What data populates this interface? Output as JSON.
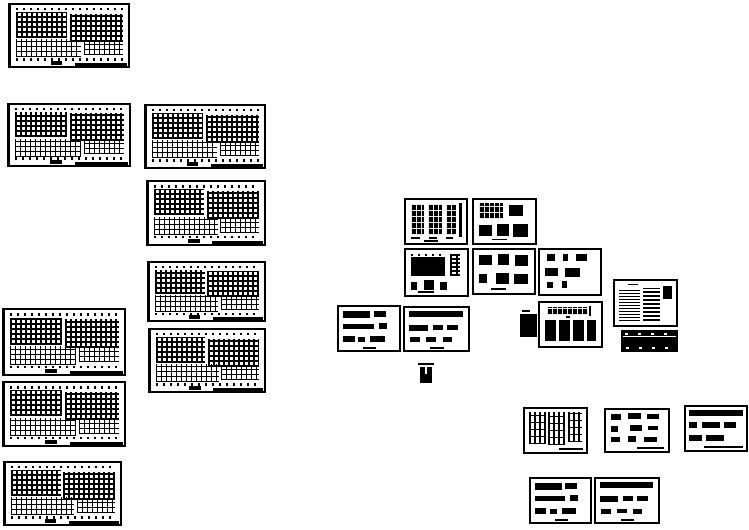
{
  "canvas": {
    "width": 749,
    "height": 530,
    "background_color": "#ffffff",
    "ink_color": "#000000",
    "description": "CAD drawing set preview, monochrome linework thumbnails"
  },
  "sheets": [
    {
      "name": "floor-plan-1",
      "kind": "floor-plan",
      "x": 8,
      "y": 3,
      "w": 122,
      "h": 65
    },
    {
      "name": "floor-plan-2",
      "kind": "floor-plan",
      "x": 7,
      "y": 103,
      "w": 124,
      "h": 64
    },
    {
      "name": "floor-plan-3",
      "kind": "floor-plan",
      "x": 144,
      "y": 104,
      "w": 122,
      "h": 65
    },
    {
      "name": "floor-plan-4",
      "kind": "floor-plan",
      "x": 146,
      "y": 180,
      "w": 120,
      "h": 66
    },
    {
      "name": "floor-plan-5",
      "kind": "floor-plan",
      "x": 147,
      "y": 261,
      "w": 119,
      "h": 61
    },
    {
      "name": "floor-plan-6",
      "kind": "floor-plan",
      "x": 148,
      "y": 328,
      "w": 118,
      "h": 65
    },
    {
      "name": "floor-plan-7",
      "kind": "floor-plan",
      "x": 2,
      "y": 308,
      "w": 124,
      "h": 68
    },
    {
      "name": "floor-plan-8",
      "kind": "floor-plan",
      "x": 2,
      "y": 381,
      "w": 124,
      "h": 66
    },
    {
      "name": "floor-plan-9",
      "kind": "floor-plan",
      "x": 3,
      "y": 461,
      "w": 119,
      "h": 65
    },
    {
      "name": "column-elevation-sheet",
      "kind": "column-elevations",
      "x": 404,
      "y": 198,
      "w": 64,
      "h": 47
    },
    {
      "name": "detail-sheet-a",
      "kind": "details-a",
      "x": 472,
      "y": 198,
      "w": 65,
      "h": 47
    },
    {
      "name": "beam-elevation-sheet",
      "kind": "beam-elevation",
      "x": 404,
      "y": 248,
      "w": 65,
      "h": 49
    },
    {
      "name": "detail-sheet-b",
      "kind": "details-b",
      "x": 472,
      "y": 248,
      "w": 64,
      "h": 47
    },
    {
      "name": "detail-sheet-c",
      "kind": "details-c",
      "x": 538,
      "y": 248,
      "w": 64,
      "h": 48
    },
    {
      "name": "general-notes-sheet",
      "kind": "general-notes",
      "x": 613,
      "y": 279,
      "w": 65,
      "h": 48
    },
    {
      "name": "schedule-table",
      "kind": "schedule-table",
      "x": 621,
      "y": 330,
      "w": 57,
      "h": 22
    },
    {
      "name": "bar-detail-sheet-1",
      "kind": "bar-details",
      "x": 337,
      "y": 305,
      "w": 64,
      "h": 47
    },
    {
      "name": "bar-detail-sheet-2",
      "kind": "bar-details-b",
      "x": 403,
      "y": 306,
      "w": 67,
      "h": 46
    },
    {
      "name": "solid-detail-chip",
      "kind": "black-chip",
      "x": 520,
      "y": 314,
      "w": 17,
      "h": 23
    },
    {
      "name": "beam-and-columns-sheet",
      "kind": "beam-columns",
      "x": 538,
      "y": 301,
      "w": 65,
      "h": 47
    },
    {
      "name": "small-section-mark",
      "kind": "small-section",
      "x": 420,
      "y": 367,
      "w": 12,
      "h": 16
    },
    {
      "name": "wall-section-sheet",
      "kind": "wall-sections",
      "x": 523,
      "y": 407,
      "w": 65,
      "h": 47
    },
    {
      "name": "detail-grid-sheet",
      "kind": "details-grid",
      "x": 604,
      "y": 408,
      "w": 66,
      "h": 45
    },
    {
      "name": "detail-bar-sheet",
      "kind": "details-bar",
      "x": 684,
      "y": 405,
      "w": 64,
      "h": 47
    },
    {
      "name": "bar-detail-sheet-3",
      "kind": "bar-details",
      "x": 529,
      "y": 477,
      "w": 63,
      "h": 47
    },
    {
      "name": "bar-detail-sheet-4",
      "kind": "bar-details-b",
      "x": 594,
      "y": 477,
      "w": 66,
      "h": 47
    }
  ]
}
